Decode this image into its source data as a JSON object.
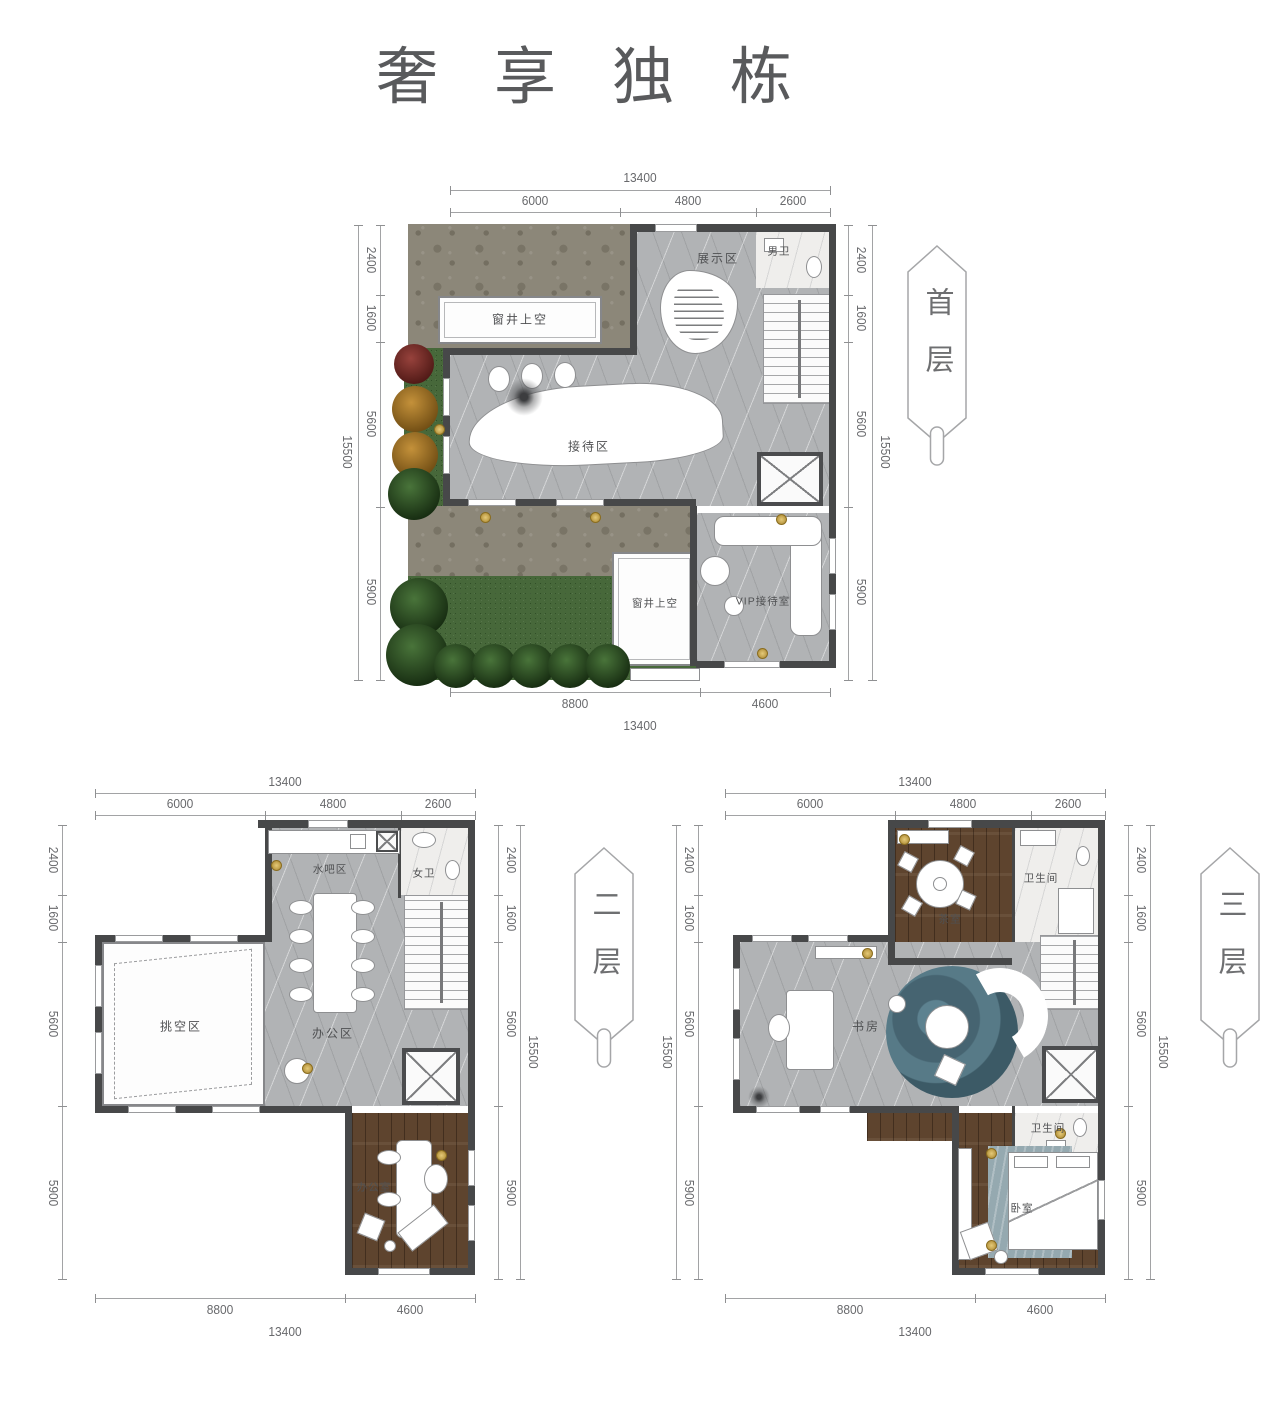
{
  "title": "奢享独栋",
  "colors": {
    "wall": "#474849",
    "marble_floor": "#b1b3b5",
    "wood_floor": "#5e442e",
    "grass": "#47683a",
    "paving": "#8c8779",
    "teal_rug": "#466471",
    "dim_text": "#68696c"
  },
  "floors": {
    "first": {
      "banner": "首层",
      "rooms": {
        "display": "展示区",
        "male_wc": "男卫",
        "window_well_top": "窗井上空",
        "reception": "接待区",
        "window_well_bottom": "窗井上空",
        "vip": "VIP接待室"
      },
      "dims": {
        "top_total": "13400",
        "top_segs": [
          "6000",
          "4800",
          "2600"
        ],
        "left_total": "15500",
        "left_segs": [
          "2400",
          "1600",
          "5600",
          "5900"
        ],
        "right_total": "15500",
        "right_segs": [
          "2400",
          "1600",
          "5600",
          "5900"
        ],
        "bottom_segs": [
          "8800",
          "4600"
        ],
        "bottom_total": "13400"
      }
    },
    "second": {
      "banner": "二层",
      "rooms": {
        "water_bar": "水吧区",
        "female_wc": "女卫",
        "void_area": "挑空区",
        "office_area": "办公区",
        "office_room": "办公室"
      },
      "dims": {
        "top_total": "13400",
        "top_segs": [
          "6000",
          "4800",
          "2600"
        ],
        "left_segs": [
          "2400",
          "1600",
          "5600",
          "5900"
        ],
        "right_total": "15500",
        "right_segs": [
          "2400",
          "1600",
          "5600",
          "5900"
        ],
        "bottom_segs": [
          "8800",
          "4600"
        ],
        "bottom_total": "13400"
      }
    },
    "third": {
      "banner": "三层",
      "rooms": {
        "tea_room": "茶室",
        "bath_top": "卫生间",
        "study": "书房",
        "bath_mid": "卫生间",
        "bedroom": "卧室"
      },
      "dims": {
        "top_total": "13400",
        "top_segs": [
          "6000",
          "4800",
          "2600"
        ],
        "left_total": "15500",
        "left_segs": [
          "2400",
          "1600",
          "5600",
          "5900"
        ],
        "right_total": "15500",
        "right_segs": [
          "2400",
          "1600",
          "5600",
          "5900"
        ],
        "bottom_segs": [
          "8800",
          "4600"
        ],
        "bottom_total": "13400"
      }
    }
  }
}
